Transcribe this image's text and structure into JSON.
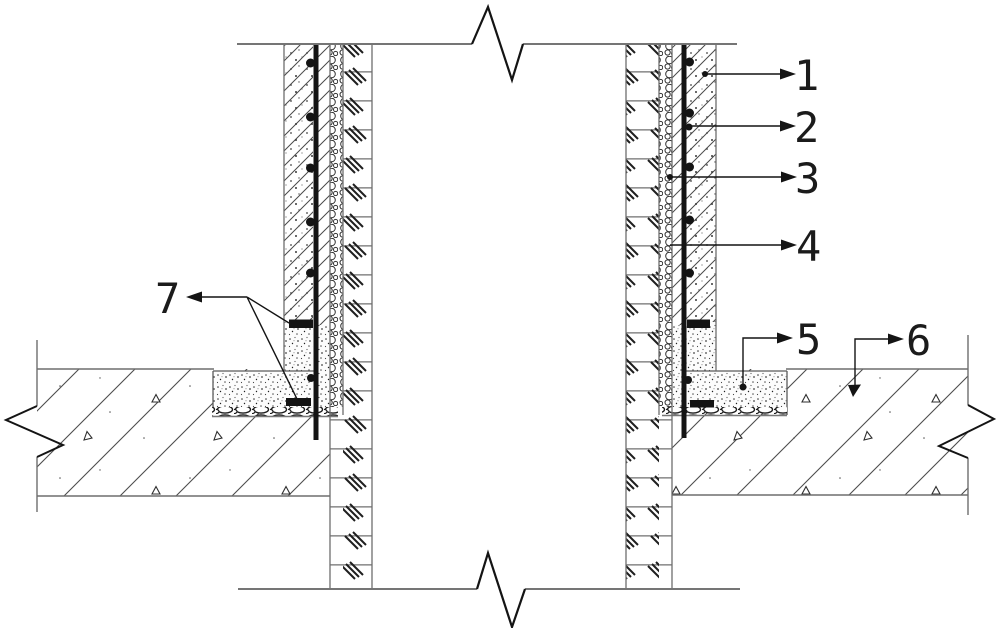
{
  "figure": {
    "kind": "wall-section-construction-detail",
    "ink_color": "#1b1b1b",
    "line_color": "#6e6e6e",
    "background": "#ffffff"
  },
  "callouts": [
    {
      "label": "1"
    },
    {
      "label": "2"
    },
    {
      "label": "3"
    },
    {
      "label": "4"
    },
    {
      "label": "5"
    },
    {
      "label": "6"
    },
    {
      "label": "7"
    }
  ]
}
